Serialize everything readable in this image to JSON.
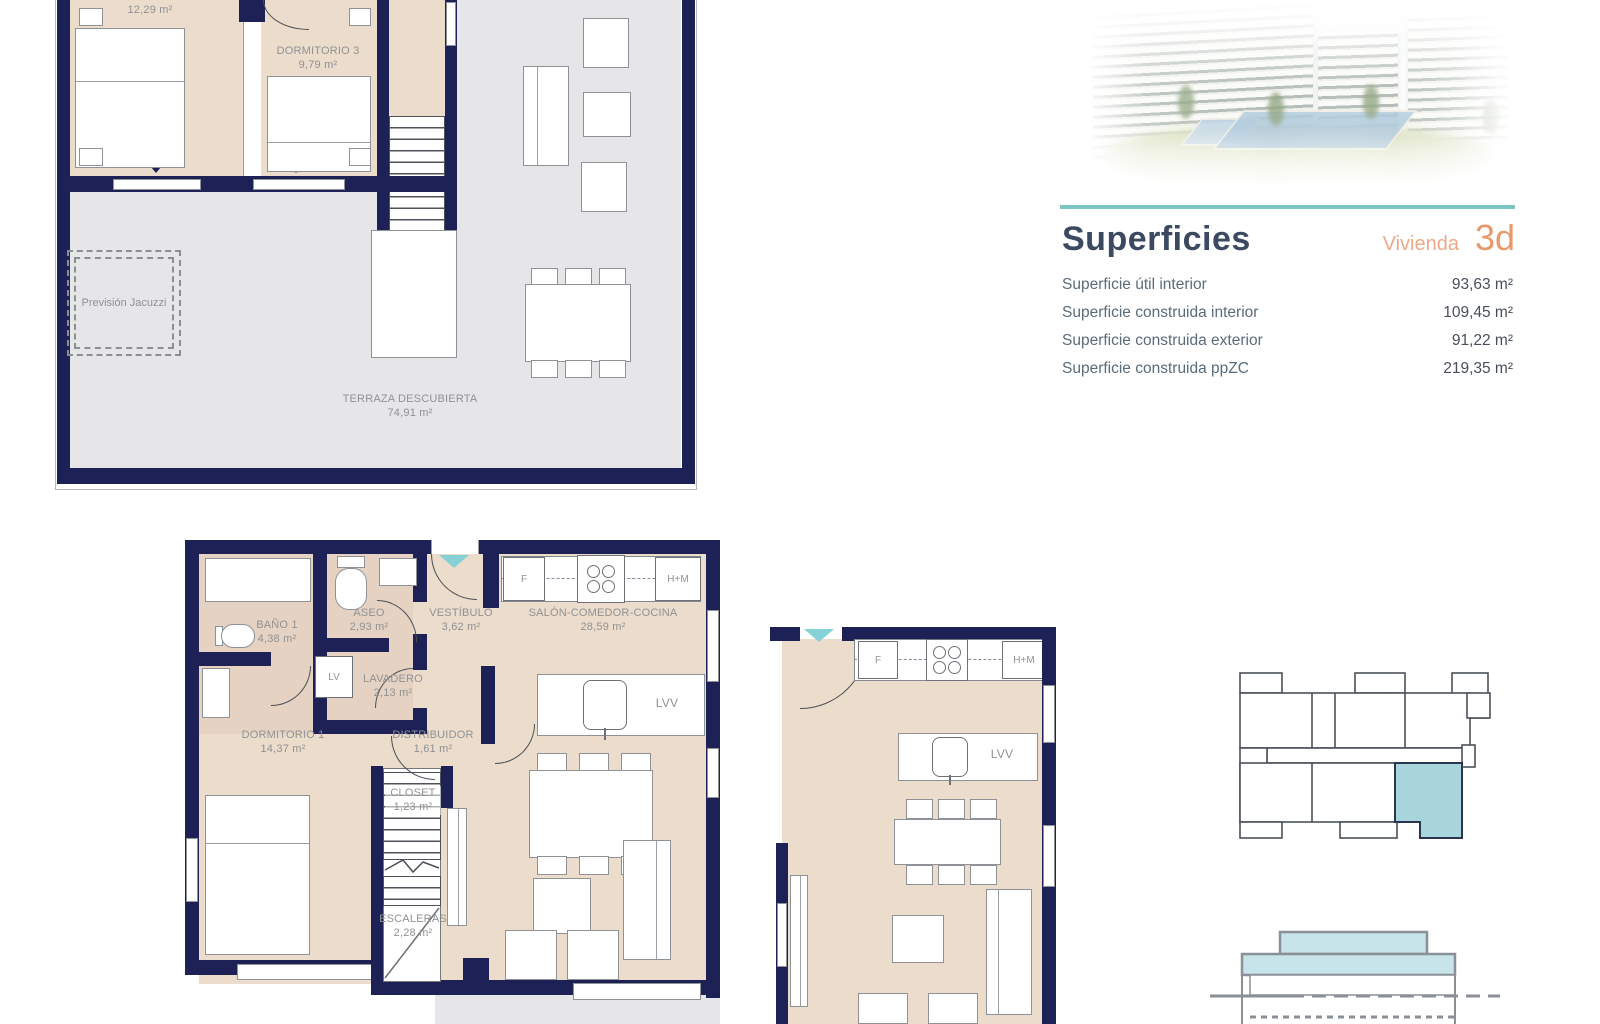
{
  "header": {
    "title": "Superficies",
    "vivienda_label": "Vivienda",
    "vivienda_code": "3d",
    "rows": [
      {
        "label": "Superficie útil interior",
        "value": "93,63 m²"
      },
      {
        "label": "Superficie construida interior",
        "value": "109,45 m²"
      },
      {
        "label": "Superficie construida exterior",
        "value": "91,22 m²"
      },
      {
        "label": "Superficie construida ppZC",
        "value": "219,35 m²"
      }
    ]
  },
  "plan_upper": {
    "bedroom2_area": "12,29 m²",
    "bedroom3_name": "DORMITORIO 3",
    "bedroom3_area": "9,79 m²",
    "terrace_name": "TERRAZA DESCUBIERTA",
    "terrace_area": "74,91 m²",
    "jacuzzi_label": "Previsión Jacuzzi"
  },
  "plan_main": {
    "rooms": {
      "bano1": {
        "name": "BAÑO 1",
        "area": "4,38 m²"
      },
      "aseo": {
        "name": "ASEO",
        "area": "2,93 m²"
      },
      "vestibulo": {
        "name": "VESTÍBULO",
        "area": "3,62 m²"
      },
      "salon": {
        "name": "SALÓN-COMEDOR-COCINA",
        "area": "28,59 m²"
      },
      "lavadero": {
        "name": "LAVADERO",
        "area": "2,13 m²"
      },
      "dormitorio1": {
        "name": "DORMITORIO 1",
        "area": "14,37 m²"
      },
      "distribuidor": {
        "name": "DISTRIBUIDOR",
        "area": "1,61 m²"
      },
      "closet": {
        "name": "CLOSET",
        "area": "1,23 m²"
      },
      "escaleras": {
        "name": "ESCALERAS",
        "area": "2,28 m²"
      }
    },
    "appliances": {
      "fridge": "F",
      "oven_micro": "H+M",
      "washer": "LV",
      "dishwasher": "LVV"
    }
  },
  "plan_detail": {
    "appliances": {
      "fridge": "F",
      "oven_micro": "H+M",
      "dishwasher": "LVV"
    }
  },
  "icons": {
    "entry_arrow": "triangle-down",
    "window_marker": "triangle-down"
  },
  "colors": {
    "wall_navy": "#1d2155",
    "room_beige": "#ecdccb",
    "terrace_grey": "#e6e5e8",
    "accent_teal_rule": "#7ec5c1",
    "entry_arrow_teal": "#85d1d6",
    "unit_highlight_teal": "#a8d4dc",
    "section_fill_teal": "#c6e4e9",
    "title_navy": "#3b4a60",
    "salmon": "#e8996b",
    "plan_label_grey": "#8f9295"
  }
}
